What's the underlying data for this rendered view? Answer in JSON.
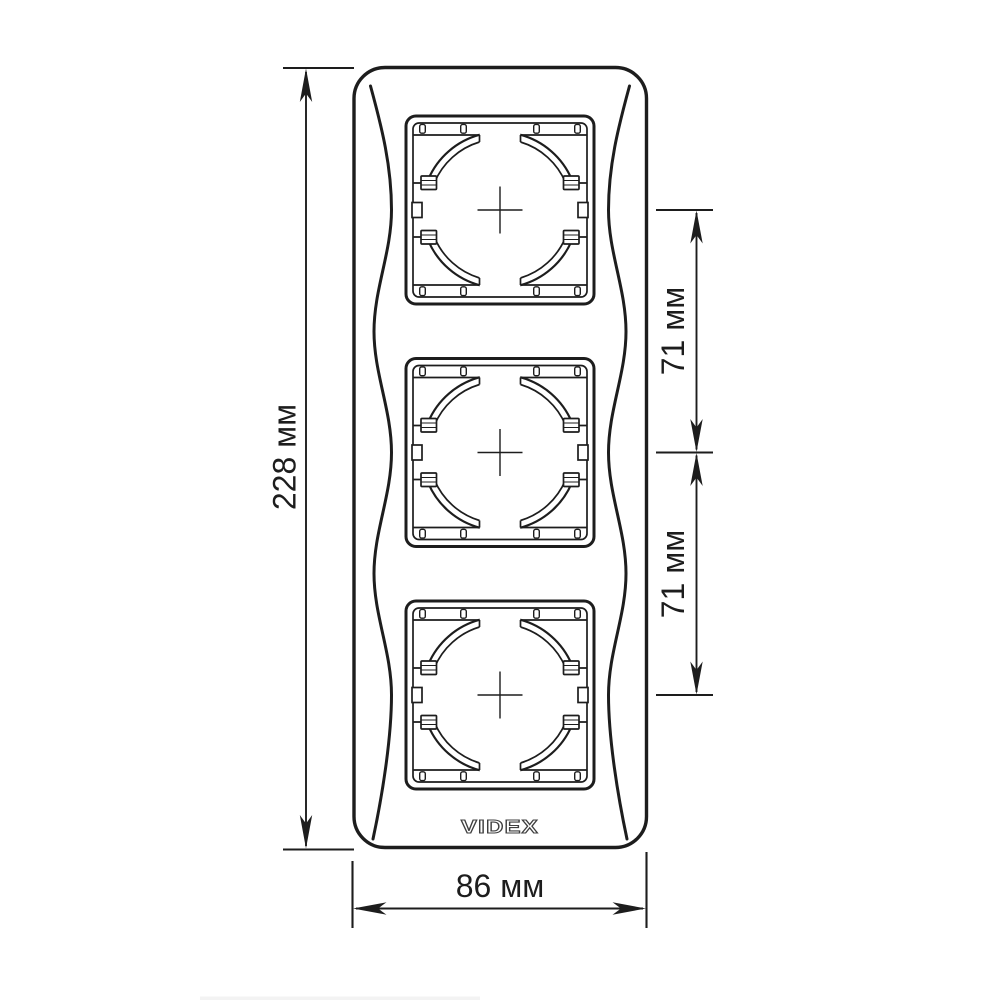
{
  "page": {
    "background_color": "#ffffff"
  },
  "drawing": {
    "line_color": "#1d1d1d",
    "logo": {
      "text": "VIDEX",
      "outline_color": "#3f3f3f"
    },
    "modules": {
      "count": 3
    },
    "dimensions": {
      "overall_height": {
        "label": "228 мм"
      },
      "overall_width": {
        "label": "86 мм"
      },
      "spacing_upper": {
        "label": "71 мм"
      },
      "spacing_lower": {
        "label": "71 мм"
      }
    }
  }
}
